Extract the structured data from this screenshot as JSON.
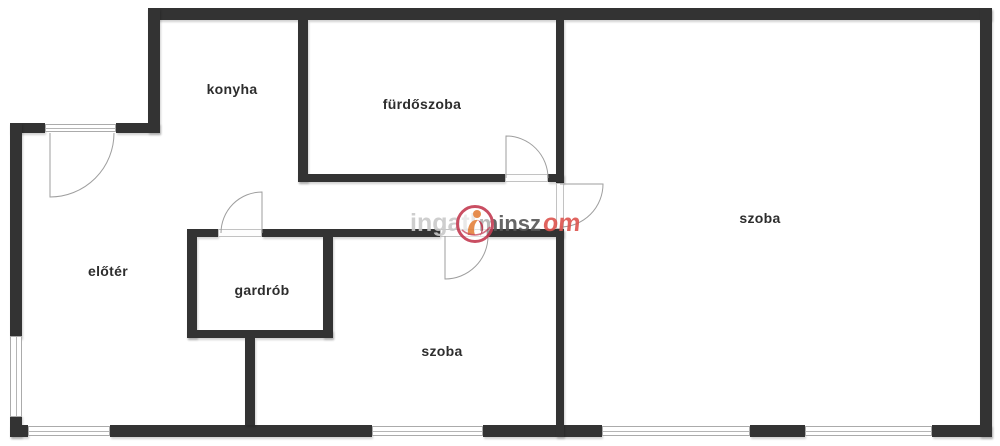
{
  "rooms": [
    {
      "id": "konyha",
      "label": "konyha"
    },
    {
      "id": "furdoszoba",
      "label": "fürdőszoba"
    },
    {
      "id": "eloter",
      "label": "előtér"
    },
    {
      "id": "gardrob",
      "label": "gardrób"
    },
    {
      "id": "szoba-bottom",
      "label": "szoba"
    },
    {
      "id": "szoba-right",
      "label": "szoba"
    }
  ],
  "watermark": {
    "part_gray": "ingatl",
    "part_dark": "minsz",
    "part_red": "om"
  },
  "colors": {
    "wall": "#333333",
    "window_line": "#ababab",
    "door_line": "#9e9e9e",
    "label_text": "#2d2d2d",
    "watermark_gray": "#c9c9c9",
    "watermark_dark": "#565656",
    "watermark_red": "#dd544e",
    "logo_ring": "#c43b52",
    "logo_orange": "#e4813c"
  }
}
